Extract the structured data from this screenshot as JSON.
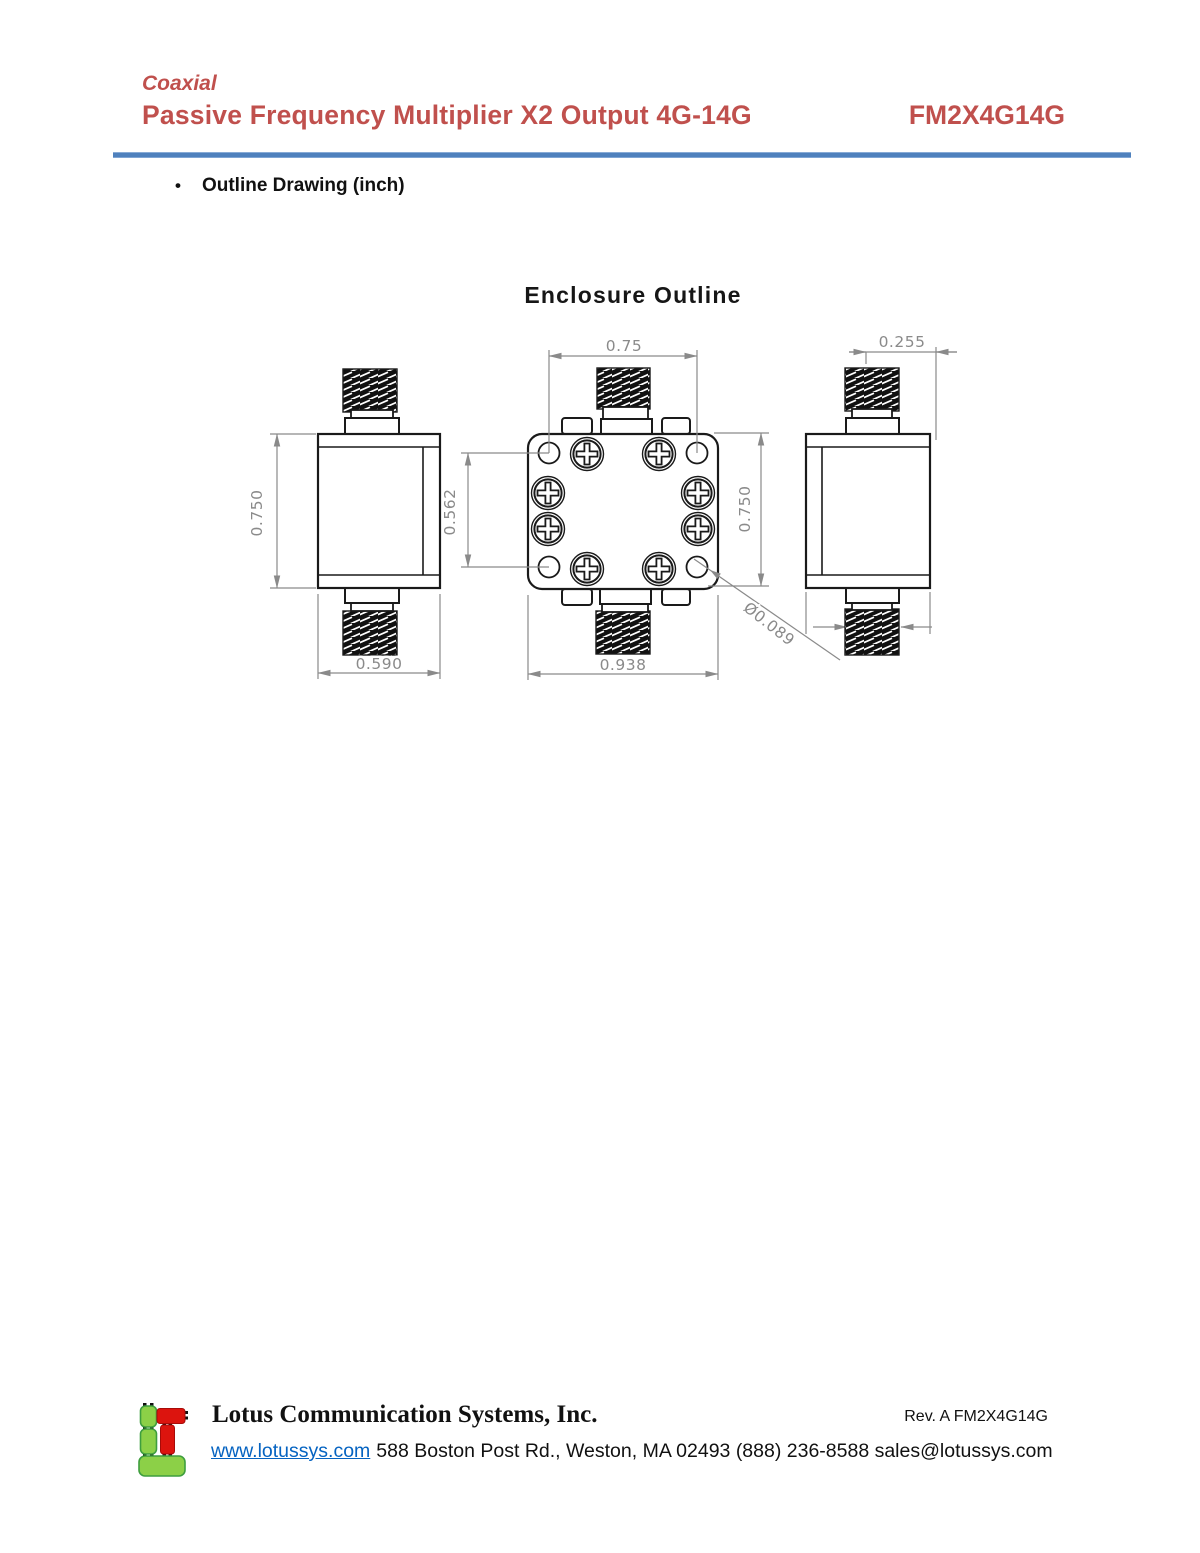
{
  "header": {
    "category": "Coaxial",
    "title": "Passive Frequency Multiplier X2 Output 4G-14G",
    "part_number": "FM2X4G14G"
  },
  "section": {
    "bullet_glyph": "•",
    "label": "Outline Drawing (inch)"
  },
  "drawing": {
    "title": "Enclosure Outline",
    "dimensions": {
      "body_height": "0.750",
      "body_width": "0.590",
      "hole_spacing_horizontal": "0.75",
      "hole_spacing_vertical": "0.562",
      "plate_height": "0.750",
      "plate_width": "0.938",
      "hole_diameter": "Ø0.089",
      "connector_offset": "0.255"
    }
  },
  "footer": {
    "company": "Lotus Communication Systems, Inc.",
    "revision": "Rev. A FM2X4G14G",
    "website": "www.lotussys.com",
    "address": "588 Boston Post Rd., Weston, MA 02493 (888) 236-8588 sales@lotussys.com"
  },
  "colors": {
    "accent_red": "#C0504D",
    "rule_blue": "#4F81BD",
    "link_blue": "#0563C1",
    "dimension_gray": "#8a8a8a",
    "line_black": "#1a1a1a",
    "logo_green": "#8CD047",
    "logo_red": "#DC140E"
  }
}
